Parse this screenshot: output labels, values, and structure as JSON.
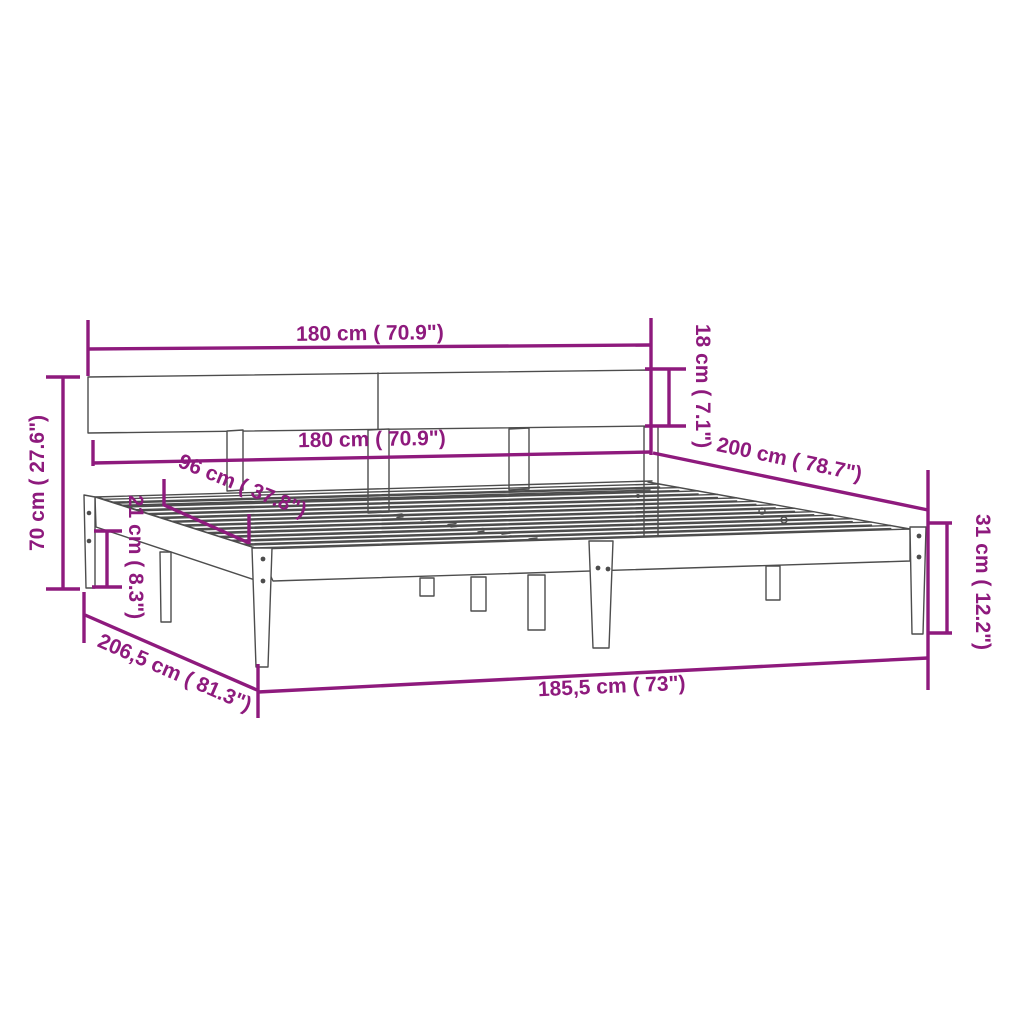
{
  "diagram": {
    "accent_color": "#8E1A7D",
    "line_color": "#4d4d4d",
    "background_color": "#ffffff",
    "dimensions": {
      "headboard_width_top": {
        "label": "180 cm ( 70.9\")"
      },
      "frame_width_inner": {
        "label": "180 cm ( 70.9\")"
      },
      "headboard_panel_height": {
        "label": "18 cm ( 7.1\")"
      },
      "total_height": {
        "label": "70 cm ( 27.6\")"
      },
      "slat_section_width": {
        "label": "96 cm ( 37.8\")"
      },
      "under_clearance_height": {
        "label": "21 cm ( 8.3\")"
      },
      "mattress_length": {
        "label": "200 cm ( 78.7\")"
      },
      "side_rail_height": {
        "label": "31 cm ( 12.2\")"
      },
      "total_length": {
        "label": "206,5 cm ( 81.3\")"
      },
      "side_rail_length": {
        "label": "185,5 cm ( 73\")"
      }
    }
  }
}
